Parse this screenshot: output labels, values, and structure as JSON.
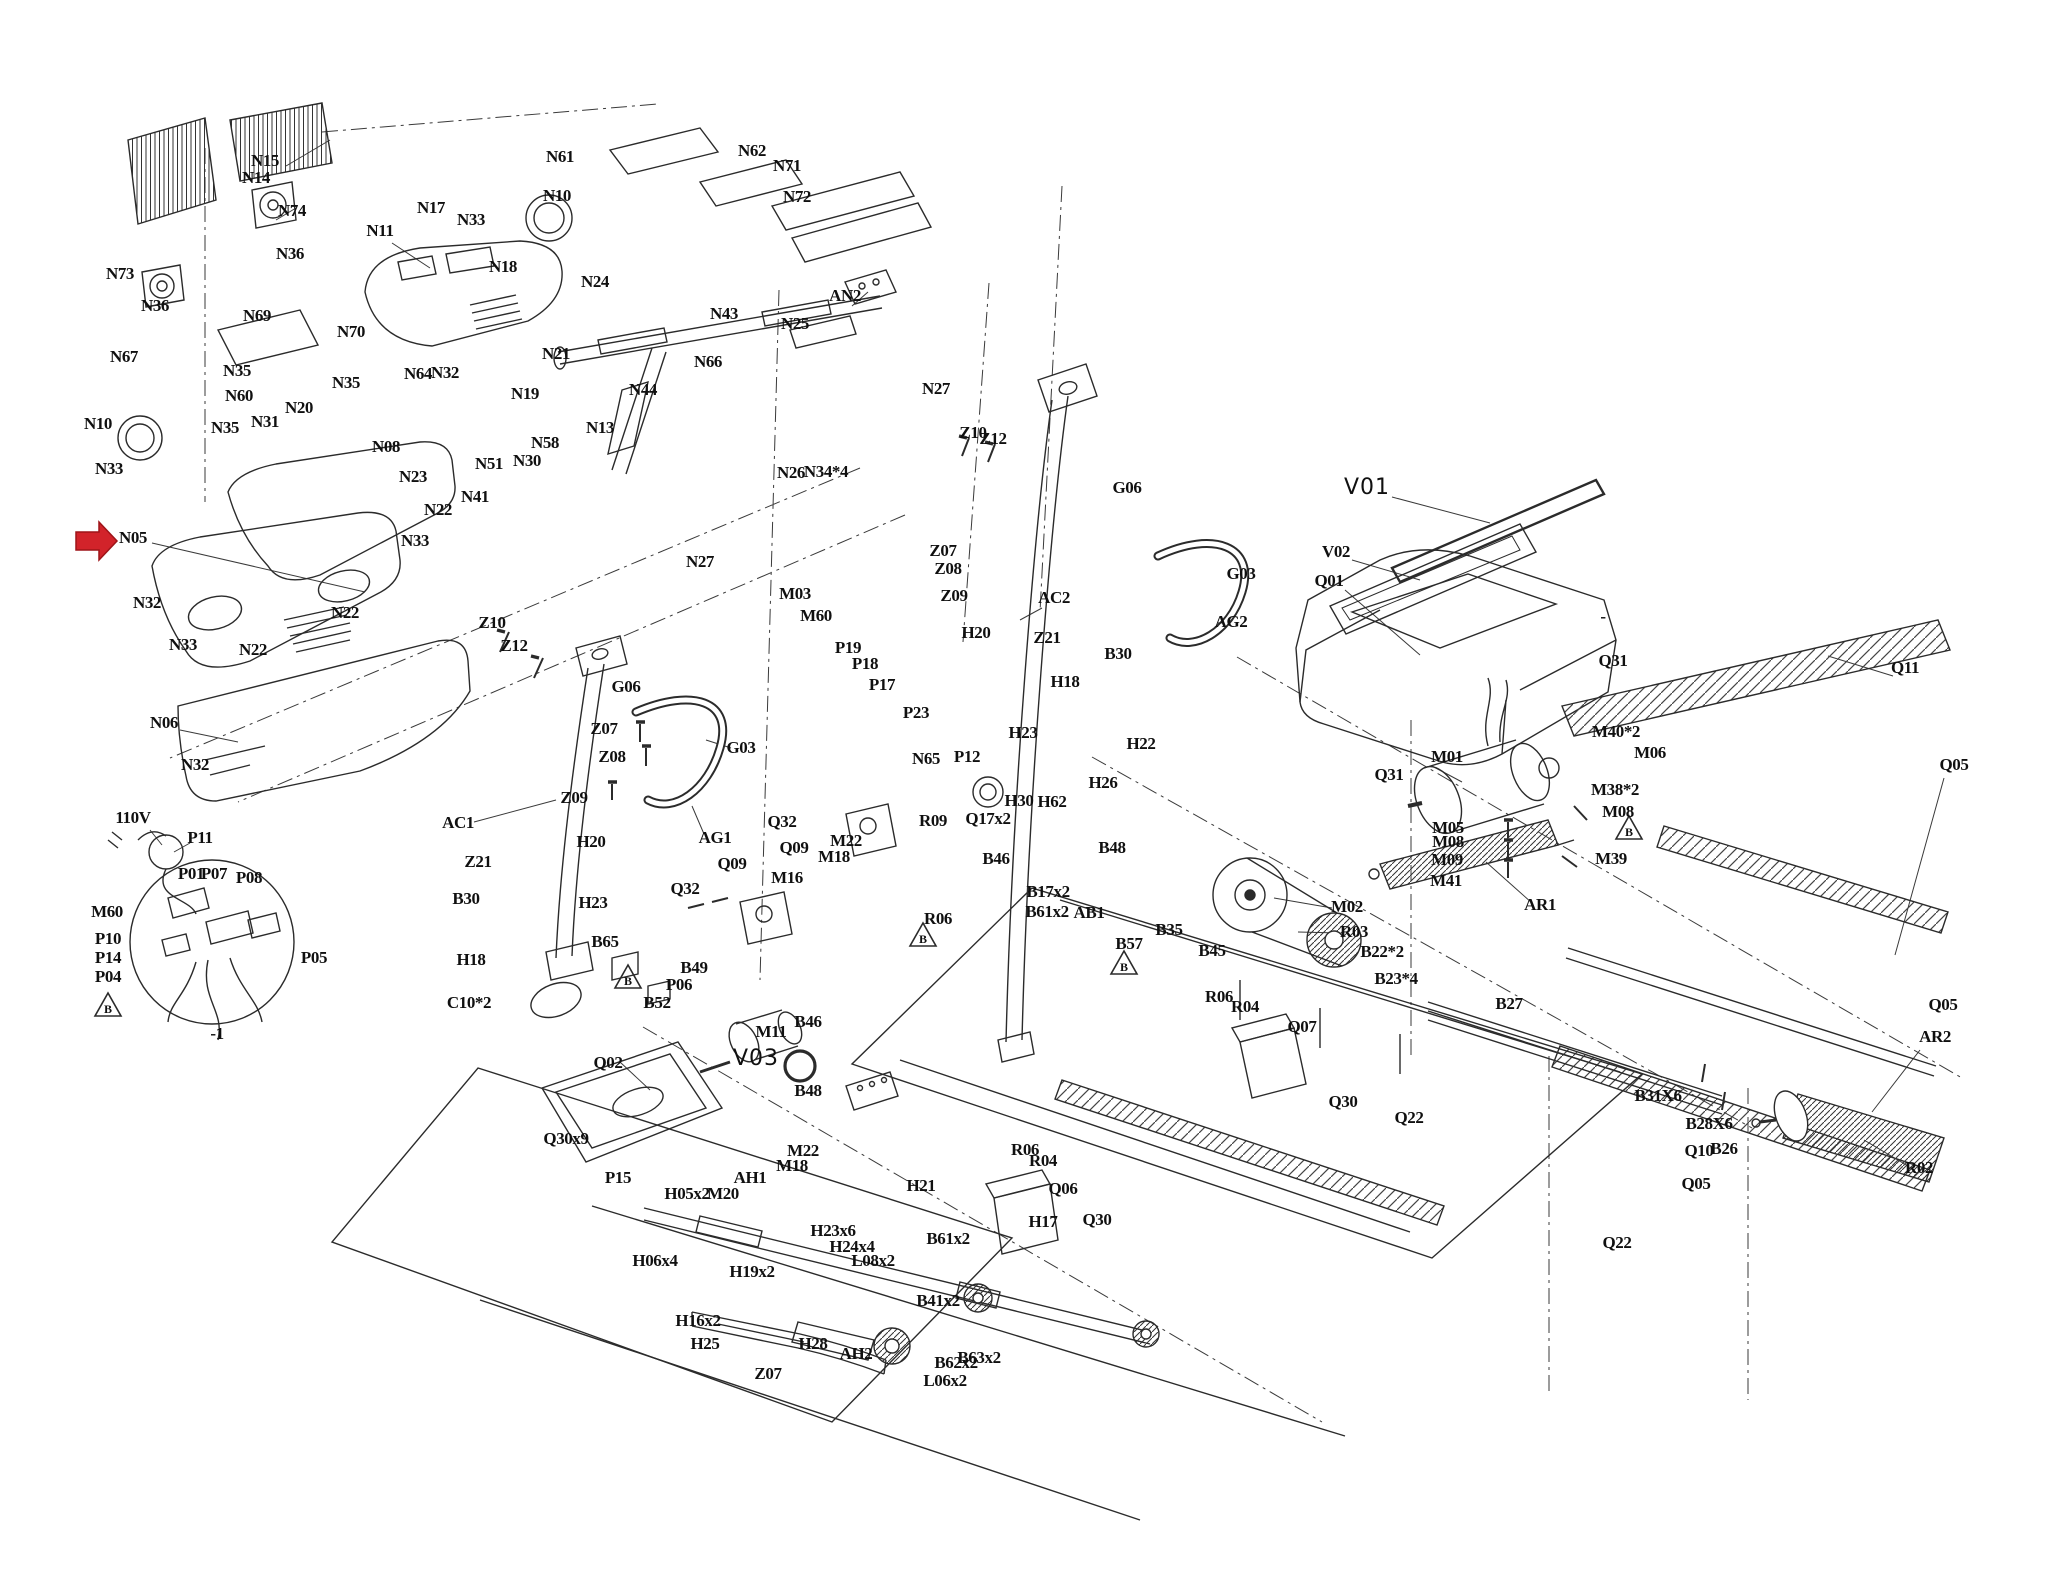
{
  "figure": {
    "type": "exploded-parts-diagram",
    "subject": "treadmill assembly exploded view",
    "background": "#ffffff",
    "line_color": "#2b2b2b",
    "label_color": "#101010"
  },
  "highlight_arrow": {
    "points_to": "N05",
    "color": "#d2232a"
  },
  "warning_triangles": [
    {
      "letter": "B",
      "x": 108,
      "y": 1007
    },
    {
      "letter": "B",
      "x": 628,
      "y": 979
    },
    {
      "letter": "B",
      "x": 923,
      "y": 937
    },
    {
      "letter": "B",
      "x": 1124,
      "y": 965
    },
    {
      "letter": "B",
      "x": 1629,
      "y": 830
    }
  ],
  "labels": [
    {
      "t": "N15",
      "x": 265,
      "y": 166
    },
    {
      "t": "N14",
      "x": 256,
      "y": 183
    },
    {
      "t": "N74",
      "x": 292,
      "y": 216
    },
    {
      "t": "N36",
      "x": 290,
      "y": 259
    },
    {
      "t": "N73",
      "x": 120,
      "y": 279
    },
    {
      "t": "N36",
      "x": 155,
      "y": 311
    },
    {
      "t": "N69",
      "x": 257,
      "y": 321
    },
    {
      "t": "N70",
      "x": 351,
      "y": 337
    },
    {
      "t": "N67",
      "x": 124,
      "y": 362
    },
    {
      "t": "N35",
      "x": 237,
      "y": 376
    },
    {
      "t": "N35",
      "x": 346,
      "y": 388
    },
    {
      "t": "N64",
      "x": 418,
      "y": 379
    },
    {
      "t": "N32",
      "x": 445,
      "y": 378
    },
    {
      "t": "N60",
      "x": 239,
      "y": 401
    },
    {
      "t": "N20",
      "x": 299,
      "y": 413
    },
    {
      "t": "N31",
      "x": 265,
      "y": 427
    },
    {
      "t": "N35",
      "x": 225,
      "y": 433
    },
    {
      "t": "N10",
      "x": 98,
      "y": 429
    },
    {
      "t": "N33",
      "x": 109,
      "y": 474
    },
    {
      "t": "N11",
      "x": 380,
      "y": 236
    },
    {
      "t": "N17",
      "x": 431,
      "y": 213
    },
    {
      "t": "N33",
      "x": 471,
      "y": 225
    },
    {
      "t": "N18",
      "x": 503,
      "y": 272
    },
    {
      "t": "N10",
      "x": 557,
      "y": 201
    },
    {
      "t": "N61",
      "x": 560,
      "y": 162
    },
    {
      "t": "N62",
      "x": 752,
      "y": 156
    },
    {
      "t": "N71",
      "x": 787,
      "y": 171
    },
    {
      "t": "N72",
      "x": 797,
      "y": 202
    },
    {
      "t": "N24",
      "x": 595,
      "y": 287
    },
    {
      "t": "N43",
      "x": 724,
      "y": 319
    },
    {
      "t": "N44",
      "x": 643,
      "y": 395
    },
    {
      "t": "N66",
      "x": 708,
      "y": 367
    },
    {
      "t": "N25",
      "x": 795,
      "y": 329
    },
    {
      "t": "AN2",
      "x": 845,
      "y": 301
    },
    {
      "t": "N21",
      "x": 556,
      "y": 359
    },
    {
      "t": "N19",
      "x": 525,
      "y": 399
    },
    {
      "t": "N13",
      "x": 600,
      "y": 433
    },
    {
      "t": "N58",
      "x": 545,
      "y": 448
    },
    {
      "t": "N51",
      "x": 489,
      "y": 469
    },
    {
      "t": "N30",
      "x": 527,
      "y": 466
    },
    {
      "t": "N41",
      "x": 475,
      "y": 502
    },
    {
      "t": "N22",
      "x": 438,
      "y": 515
    },
    {
      "t": "N08",
      "x": 386,
      "y": 452
    },
    {
      "t": "N23",
      "x": 413,
      "y": 482
    },
    {
      "t": "N05",
      "x": 133,
      "y": 543
    },
    {
      "t": "N33",
      "x": 415,
      "y": 546
    },
    {
      "t": "N32",
      "x": 147,
      "y": 608
    },
    {
      "t": "N33",
      "x": 183,
      "y": 650
    },
    {
      "t": "N22",
      "x": 345,
      "y": 618
    },
    {
      "t": "N22",
      "x": 253,
      "y": 655
    },
    {
      "t": "N06",
      "x": 164,
      "y": 728
    },
    {
      "t": "N32",
      "x": 195,
      "y": 770
    },
    {
      "t": "N26",
      "x": 791,
      "y": 478
    },
    {
      "t": "N34*4",
      "x": 826,
      "y": 477
    },
    {
      "t": "N27",
      "x": 936,
      "y": 394
    },
    {
      "t": "N27",
      "x": 700,
      "y": 567
    },
    {
      "t": "Z10",
      "x": 492,
      "y": 628
    },
    {
      "t": "Z12",
      "x": 514,
      "y": 651
    },
    {
      "t": "G06",
      "x": 626,
      "y": 692
    },
    {
      "t": "Z07",
      "x": 604,
      "y": 734
    },
    {
      "t": "Z08",
      "x": 612,
      "y": 762
    },
    {
      "t": "Z09",
      "x": 574,
      "y": 803
    },
    {
      "t": "G03",
      "x": 741,
      "y": 753
    },
    {
      "t": "AG1",
      "x": 715,
      "y": 843
    },
    {
      "t": "AC1",
      "x": 458,
      "y": 828
    },
    {
      "t": "Z10",
      "x": 973,
      "y": 438
    },
    {
      "t": "Z12",
      "x": 993,
      "y": 444
    },
    {
      "t": "Z07",
      "x": 943,
      "y": 556
    },
    {
      "t": "Z08",
      "x": 948,
      "y": 574
    },
    {
      "t": "Z09",
      "x": 954,
      "y": 601
    },
    {
      "t": "AC2",
      "x": 1054,
      "y": 603
    },
    {
      "t": "G06",
      "x": 1127,
      "y": 493
    },
    {
      "t": "G03",
      "x": 1241,
      "y": 579
    },
    {
      "t": "AG2",
      "x": 1231,
      "y": 627
    },
    {
      "t": "H20",
      "x": 591,
      "y": 847
    },
    {
      "t": "Z21",
      "x": 478,
      "y": 867
    },
    {
      "t": "B30",
      "x": 466,
      "y": 904
    },
    {
      "t": "H23",
      "x": 593,
      "y": 908
    },
    {
      "t": "B65",
      "x": 605,
      "y": 947
    },
    {
      "t": "H18",
      "x": 471,
      "y": 965
    },
    {
      "t": "C10*2",
      "x": 469,
      "y": 1008
    },
    {
      "t": "B49",
      "x": 694,
      "y": 973
    },
    {
      "t": "P06",
      "x": 679,
      "y": 990
    },
    {
      "t": "B52",
      "x": 657,
      "y": 1008
    },
    {
      "t": "H20",
      "x": 976,
      "y": 638
    },
    {
      "t": "Z21",
      "x": 1047,
      "y": 643
    },
    {
      "t": "B30",
      "x": 1118,
      "y": 659
    },
    {
      "t": "H18",
      "x": 1065,
      "y": 687
    },
    {
      "t": "H23",
      "x": 1023,
      "y": 738
    },
    {
      "t": "H22",
      "x": 1141,
      "y": 749
    },
    {
      "t": "H26",
      "x": 1103,
      "y": 788
    },
    {
      "t": "H30",
      "x": 1019,
      "y": 806
    },
    {
      "t": "H62",
      "x": 1052,
      "y": 807
    },
    {
      "t": "M03",
      "x": 795,
      "y": 599
    },
    {
      "t": "M60",
      "x": 816,
      "y": 621
    },
    {
      "t": "P19",
      "x": 848,
      "y": 653
    },
    {
      "t": "P18",
      "x": 865,
      "y": 669
    },
    {
      "t": "P17",
      "x": 882,
      "y": 690
    },
    {
      "t": "P23",
      "x": 916,
      "y": 718
    },
    {
      "t": "N65",
      "x": 926,
      "y": 764
    },
    {
      "t": "P12",
      "x": 967,
      "y": 762
    },
    {
      "t": "Q32",
      "x": 782,
      "y": 827
    },
    {
      "t": "Q09",
      "x": 794,
      "y": 853
    },
    {
      "t": "Q32",
      "x": 685,
      "y": 894
    },
    {
      "t": "Q09",
      "x": 732,
      "y": 869
    },
    {
      "t": "M22",
      "x": 846,
      "y": 846
    },
    {
      "t": "M18",
      "x": 834,
      "y": 862
    },
    {
      "t": "M16",
      "x": 787,
      "y": 883
    },
    {
      "t": "R09",
      "x": 933,
      "y": 826
    },
    {
      "t": "Q17x2",
      "x": 988,
      "y": 824
    },
    {
      "t": "B46",
      "x": 996,
      "y": 864
    },
    {
      "t": "R06",
      "x": 938,
      "y": 924
    },
    {
      "t": "B17x2",
      "x": 1048,
      "y": 897
    },
    {
      "t": "B61x2",
      "x": 1047,
      "y": 917
    },
    {
      "t": "AB1",
      "x": 1089,
      "y": 918
    },
    {
      "t": "B57",
      "x": 1129,
      "y": 949
    },
    {
      "t": "B48",
      "x": 1112,
      "y": 853
    },
    {
      "t": "B35",
      "x": 1169,
      "y": 935
    },
    {
      "t": "B45",
      "x": 1212,
      "y": 956
    },
    {
      "t": "R06",
      "x": 1219,
      "y": 1002
    },
    {
      "t": "R04",
      "x": 1245,
      "y": 1012
    },
    {
      "t": "Q07",
      "x": 1302,
      "y": 1032
    },
    {
      "t": "Q30",
      "x": 1343,
      "y": 1107
    },
    {
      "t": "R06",
      "x": 1025,
      "y": 1155
    },
    {
      "t": "R04",
      "x": 1043,
      "y": 1166
    },
    {
      "t": "Q06",
      "x": 1063,
      "y": 1194
    },
    {
      "t": "Q30",
      "x": 1097,
      "y": 1225
    },
    {
      "t": "H17",
      "x": 1043,
      "y": 1227
    },
    {
      "t": "110V",
      "x": 133,
      "y": 823
    },
    {
      "t": "P11",
      "x": 200,
      "y": 843
    },
    {
      "t": "P01",
      "x": 191,
      "y": 879
    },
    {
      "t": "P07",
      "x": 214,
      "y": 879
    },
    {
      "t": "P08",
      "x": 249,
      "y": 883
    },
    {
      "t": "M60",
      "x": 107,
      "y": 917
    },
    {
      "t": "P10",
      "x": 108,
      "y": 944
    },
    {
      "t": "P14",
      "x": 108,
      "y": 963
    },
    {
      "t": "P04",
      "x": 108,
      "y": 982
    },
    {
      "t": "P05",
      "x": 314,
      "y": 963
    },
    {
      "t": "-1",
      "x": 217,
      "y": 1039
    },
    {
      "t": "M11",
      "x": 771,
      "y": 1037
    },
    {
      "t": "V03",
      "x": 756,
      "y": 1065,
      "k": "thin"
    },
    {
      "t": "B48",
      "x": 808,
      "y": 1096
    },
    {
      "t": "B46",
      "x": 808,
      "y": 1027
    },
    {
      "t": "Q02",
      "x": 608,
      "y": 1068
    },
    {
      "t": "Q30x9",
      "x": 566,
      "y": 1144
    },
    {
      "t": "P15",
      "x": 618,
      "y": 1183
    },
    {
      "t": "AH1",
      "x": 750,
      "y": 1183
    },
    {
      "t": "H05x2",
      "x": 687,
      "y": 1199
    },
    {
      "t": "M20",
      "x": 723,
      "y": 1199
    },
    {
      "t": "M22",
      "x": 803,
      "y": 1156
    },
    {
      "t": "M18",
      "x": 792,
      "y": 1171
    },
    {
      "t": "H21",
      "x": 921,
      "y": 1191
    },
    {
      "t": "H23x6",
      "x": 833,
      "y": 1236
    },
    {
      "t": "H24x4",
      "x": 852,
      "y": 1252
    },
    {
      "t": "L08x2",
      "x": 873,
      "y": 1266
    },
    {
      "t": "H06x4",
      "x": 655,
      "y": 1266
    },
    {
      "t": "H19x2",
      "x": 752,
      "y": 1277
    },
    {
      "t": "B61x2",
      "x": 948,
      "y": 1244
    },
    {
      "t": "B41x2",
      "x": 938,
      "y": 1306
    },
    {
      "t": "H16x2",
      "x": 698,
      "y": 1326
    },
    {
      "t": "H25",
      "x": 705,
      "y": 1349
    },
    {
      "t": "H28",
      "x": 813,
      "y": 1349
    },
    {
      "t": "AH2",
      "x": 856,
      "y": 1359
    },
    {
      "t": "Z07",
      "x": 768,
      "y": 1379
    },
    {
      "t": "B62x2",
      "x": 956,
      "y": 1368
    },
    {
      "t": "B63x2",
      "x": 979,
      "y": 1363
    },
    {
      "t": "L06x2",
      "x": 945,
      "y": 1386
    },
    {
      "t": "V01",
      "x": 1367,
      "y": 494,
      "k": "thin"
    },
    {
      "t": "V02",
      "x": 1336,
      "y": 557
    },
    {
      "t": "Q01",
      "x": 1329,
      "y": 586
    },
    {
      "t": "Q31",
      "x": 1613,
      "y": 666
    },
    {
      "t": "-",
      "x": 1603,
      "y": 622
    },
    {
      "t": "Q31",
      "x": 1389,
      "y": 780
    },
    {
      "t": "M01",
      "x": 1447,
      "y": 762
    },
    {
      "t": "M40*2",
      "x": 1616,
      "y": 737
    },
    {
      "t": "M06",
      "x": 1650,
      "y": 758
    },
    {
      "t": "M38*2",
      "x": 1615,
      "y": 795
    },
    {
      "t": "M08",
      "x": 1618,
      "y": 817
    },
    {
      "t": "M05",
      "x": 1448,
      "y": 833
    },
    {
      "t": "M08",
      "x": 1448,
      "y": 847
    },
    {
      "t": "M09",
      "x": 1447,
      "y": 865
    },
    {
      "t": "M41",
      "x": 1446,
      "y": 886
    },
    {
      "t": "M39",
      "x": 1611,
      "y": 864
    },
    {
      "t": "AR1",
      "x": 1540,
      "y": 910
    },
    {
      "t": "M02",
      "x": 1347,
      "y": 912
    },
    {
      "t": "R03",
      "x": 1354,
      "y": 937
    },
    {
      "t": "B22*2",
      "x": 1382,
      "y": 957
    },
    {
      "t": "B23*4",
      "x": 1396,
      "y": 984
    },
    {
      "t": "B27",
      "x": 1509,
      "y": 1009
    },
    {
      "t": "Q11",
      "x": 1905,
      "y": 673
    },
    {
      "t": "Q05",
      "x": 1954,
      "y": 770
    },
    {
      "t": "Q05",
      "x": 1943,
      "y": 1010
    },
    {
      "t": "AR2",
      "x": 1935,
      "y": 1042
    },
    {
      "t": "R02",
      "x": 1919,
      "y": 1173
    },
    {
      "t": "B31X6",
      "x": 1658,
      "y": 1101
    },
    {
      "t": "B28X6",
      "x": 1709,
      "y": 1129
    },
    {
      "t": "Q10",
      "x": 1699,
      "y": 1156
    },
    {
      "t": "B26",
      "x": 1724,
      "y": 1154
    },
    {
      "t": "Q05",
      "x": 1696,
      "y": 1189
    },
    {
      "t": "Q22",
      "x": 1617,
      "y": 1248
    },
    {
      "t": "Q22",
      "x": 1409,
      "y": 1123
    }
  ]
}
